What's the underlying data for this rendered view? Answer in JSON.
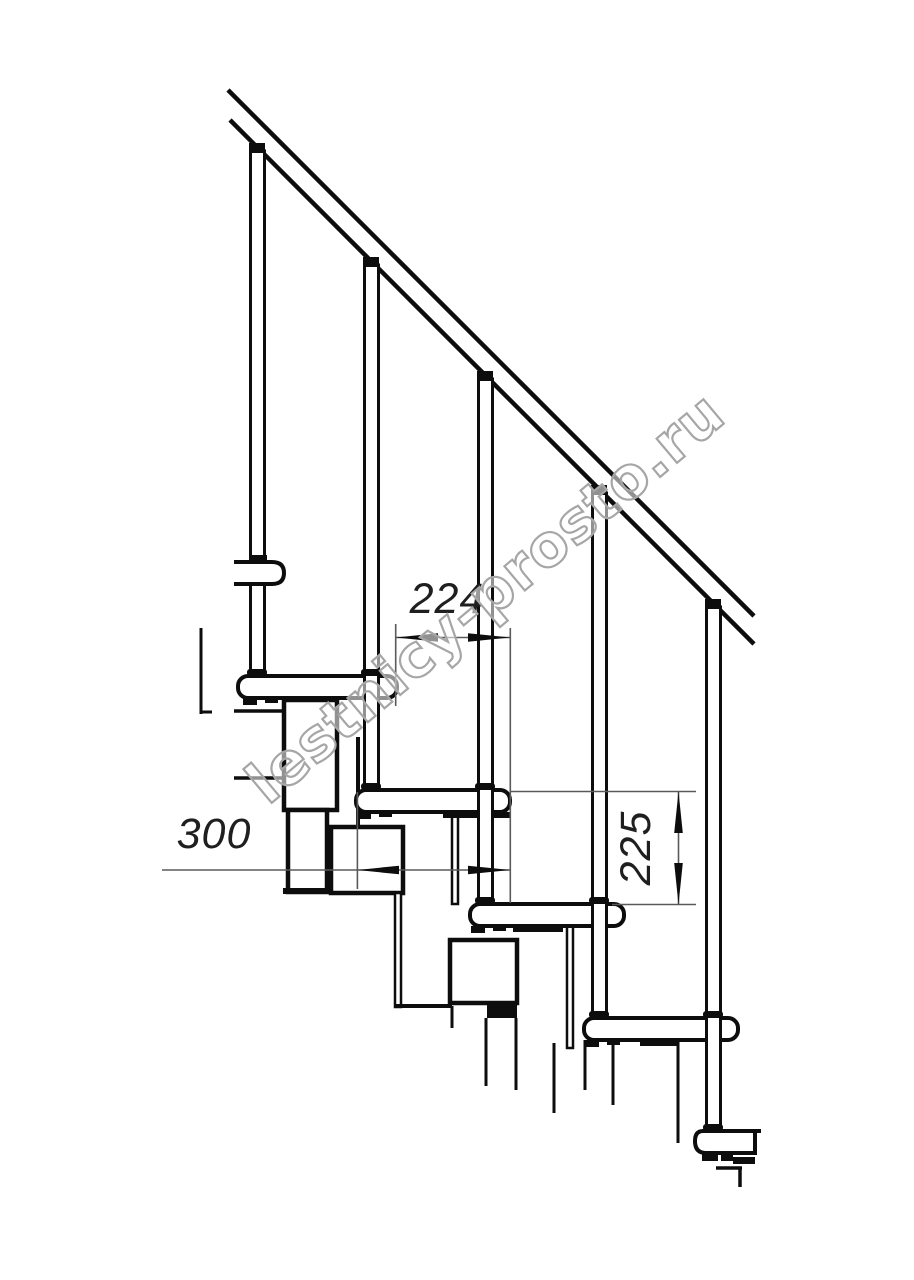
{
  "drawing": {
    "kind": "staircase-side-view-technical-drawing"
  },
  "dimensions": {
    "step_going": {
      "value": "224"
    },
    "tread_depth": {
      "value": "300"
    },
    "step_rise": {
      "value": "225"
    }
  },
  "watermark": {
    "text": "lestnicy-prosto.ru",
    "color": "#a6a6a6"
  },
  "colors": {
    "background": "#ffffff",
    "line": "#0d0d0d",
    "dimension_line": "#5a5a5a",
    "text": "#1f1f1f"
  }
}
